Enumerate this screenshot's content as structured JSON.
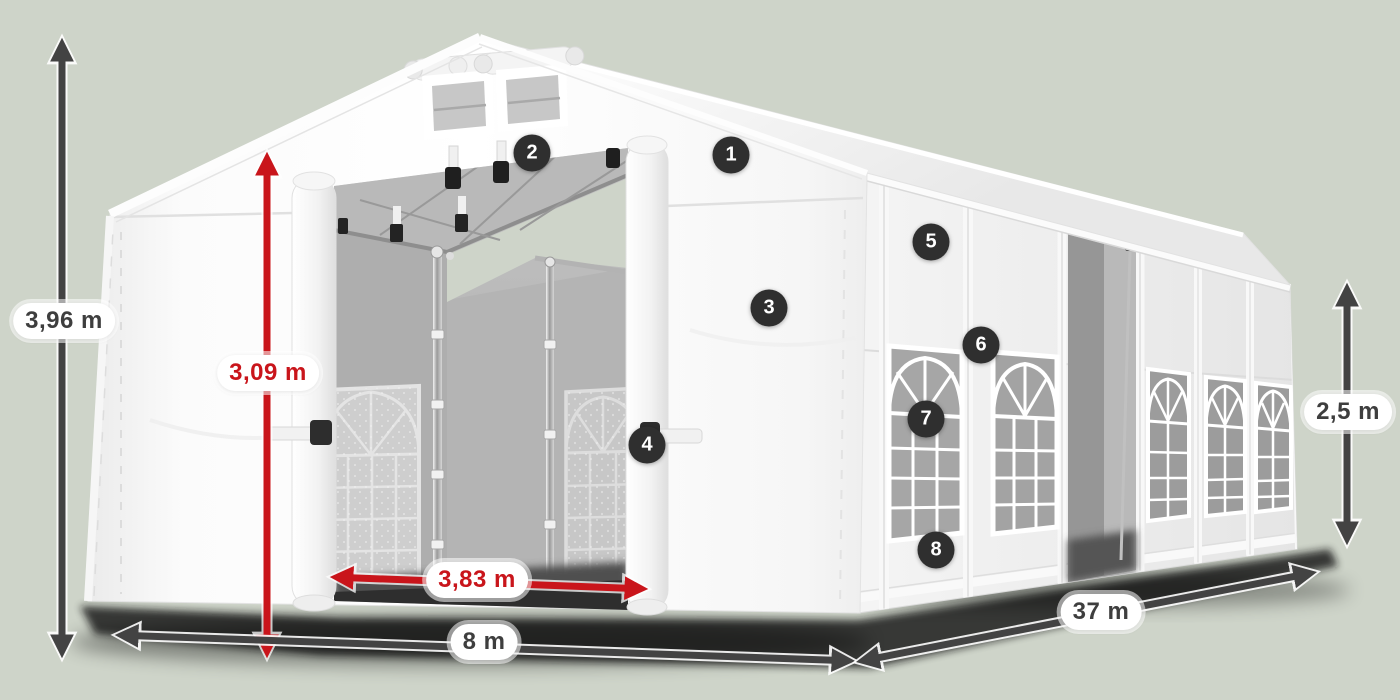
{
  "diagram": {
    "subject": "White storage tent 8 x 37 m - 3D product rendering with dimension callouts and numbered feature hotspots",
    "background_color": "#ced4c9",
    "tent_color": "#ffffff",
    "arrow_dark_color": "#434343",
    "arrow_red_color": "#c9151b",
    "badge_color": "#2f2f2f",
    "badge_text_color": "#ffffff"
  },
  "dimensions": {
    "total_height": {
      "label": "3,96 m",
      "text_color": "#3e3e3e",
      "measures": "total ridge height"
    },
    "door_height": {
      "label": "3,09 m",
      "text_color": "#c9151b",
      "measures": "entrance clearance height"
    },
    "door_width": {
      "label": "3,83 m",
      "text_color": "#c9151b",
      "measures": "entrance clearance width"
    },
    "front_width": {
      "label": "8 m",
      "text_color": "#3e3e3e",
      "measures": "gable end width"
    },
    "side_length": {
      "label": "37 m",
      "text_color": "#3e3e3e",
      "measures": "side wall length"
    },
    "side_height": {
      "label": "2,5 m",
      "text_color": "#3e3e3e",
      "measures": "side wall height"
    }
  },
  "badges": [
    "1",
    "2",
    "3",
    "4",
    "5",
    "6",
    "7",
    "8"
  ]
}
